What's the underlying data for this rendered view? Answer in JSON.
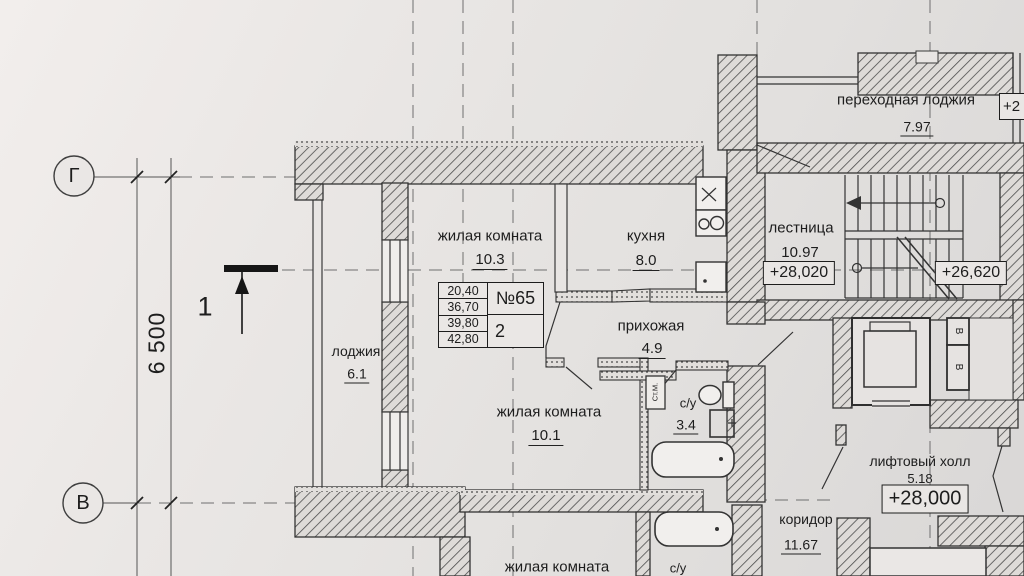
{
  "drawing": {
    "grid": {
      "axis_top": "Г",
      "axis_bottom": "В",
      "dimension": "6 500",
      "section_mark": "1"
    },
    "apartment": {
      "number": "№65",
      "rooms_count": "2",
      "areas": [
        "20,40",
        "36,70",
        "39,80",
        "42,80"
      ]
    },
    "rooms": {
      "living_top": {
        "name": "жилая комната",
        "area": "10.3"
      },
      "kitchen": {
        "name": "кухня",
        "area": "8.0"
      },
      "hallway": {
        "name": "прихожая",
        "area": "4.9"
      },
      "loggia": {
        "name": "лоджия",
        "area": "6.1"
      },
      "living_bottom": {
        "name": "жилая комната",
        "area": "10.1"
      },
      "bathroom": {
        "name": "с/у",
        "area": "3.4"
      },
      "stairs": {
        "name": "лестница",
        "area": "10.97"
      },
      "transfer_loggia": {
        "name": "переходная лоджия",
        "area": "7.97"
      },
      "lift_hall": {
        "name": "лифтовый холл",
        "area": "5.18"
      },
      "corridor": {
        "name": "коридор",
        "area": "11.67"
      },
      "lower_living": {
        "name": "жилая комната"
      },
      "lower_bathroom": {
        "name": "с/у"
      }
    },
    "elevations": {
      "stair_upper": "+28,020",
      "stair_lower": "+26,620",
      "floor": "+28,000",
      "edge_partial": "+2"
    },
    "appliances": {
      "washing_machine": "Ст.М."
    },
    "shafts": {
      "top": "В",
      "bottom": "В"
    },
    "colors": {
      "paper": "#e8e5e2",
      "line": "#2f2f2f"
    }
  }
}
